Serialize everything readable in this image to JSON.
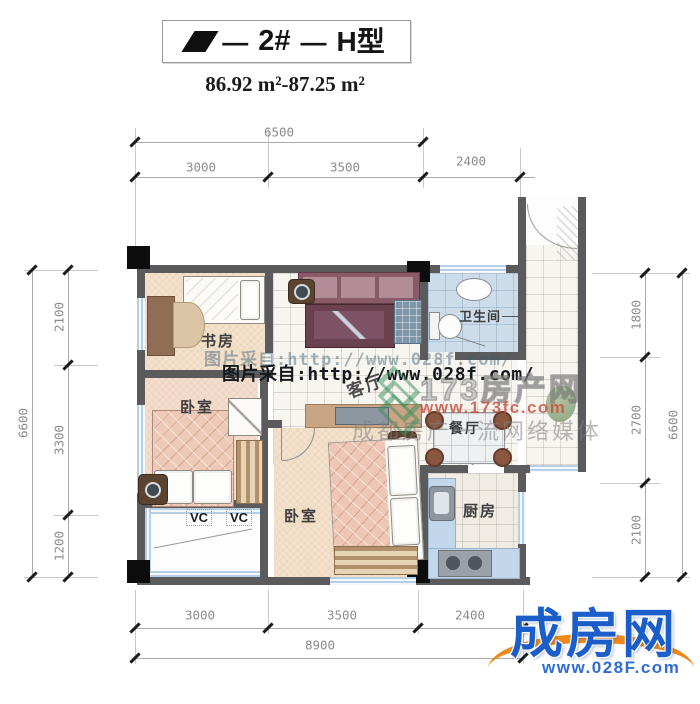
{
  "title": {
    "dash": "—",
    "unit": "2#",
    "type": "H型"
  },
  "area_text": "86.92 m²-87.25 m²",
  "dims": {
    "top_total": "6500",
    "top_1": "3000",
    "top_2": "3500",
    "top_3": "2400",
    "bottom_1": "3000",
    "bottom_2": "3500",
    "bottom_3": "2400",
    "bottom_total": "8900",
    "left_1": "2100",
    "left_2": "3300",
    "left_3": "1200",
    "left_total": "6600",
    "right_1": "1800",
    "right_2": "2700",
    "right_3": "2100",
    "right_total": "6600"
  },
  "rooms": {
    "study": "书房",
    "bedroom1": "卧室",
    "living": "客厅",
    "bathroom": "卫生间",
    "dining": "餐厅",
    "kitchen": "厨房",
    "bedroom2": "卧室",
    "vc": "VC"
  },
  "watermarks": {
    "source_line_faint": "图片采自:http://www.028f.com/",
    "source_line": "图片采自:http://www.028f.com/",
    "site_name": "173房产网",
    "site_url": "www.173fc.com",
    "slogan": "成都房产一流网络媒体"
  },
  "logo": {
    "name": "成房网",
    "url": "www.028F.com"
  },
  "colors": {
    "wall": "#5b5b5d",
    "column": "#0d0d0d",
    "bath_floor": "#ccdcea",
    "warm_floor": "#f3e1cc",
    "sofa": "#8a5a68",
    "logo_blue": "#1b5ec9",
    "logo_orange": "#ee8a1c",
    "watermark_red": "#c94b3c"
  }
}
